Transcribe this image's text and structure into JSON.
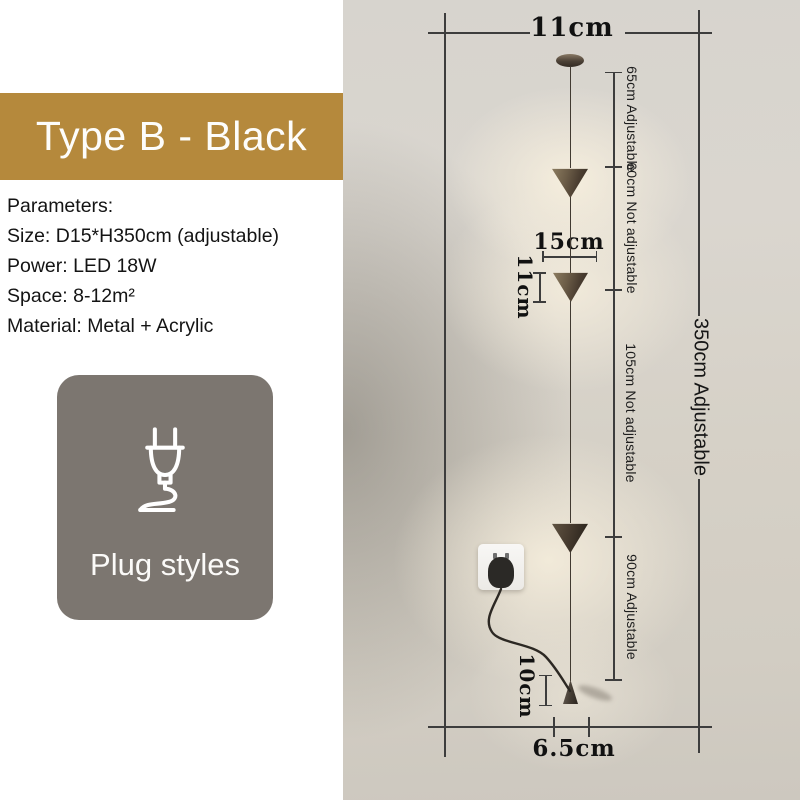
{
  "banner": {
    "label": "Type B - Black",
    "bg_color": "#b5893c",
    "text_color": "#ffffff"
  },
  "parameters": {
    "title": "Parameters:",
    "size": "Size: D15*H350cm (adjustable)",
    "power": "Power: LED 18W",
    "space": "Space: 8-12m²",
    "material": "Material: Metal + Acrylic"
  },
  "plug_box": {
    "label": "Plug styles",
    "icon": "plug-icon",
    "bg_color": "#7c7670"
  },
  "dimensions": {
    "canopy_width": "11cm",
    "segment_top": "65cm Adjustable",
    "segment_upper": "60cm Not adjustable",
    "segment_middle": "105cm Not adjustable",
    "segment_lower": "90cm Adjustable",
    "total_height": "350cm Adjustable",
    "shade_spacing": "15cm",
    "shade_height": "11cm",
    "floor_spike_height": "10cm",
    "base_width": "6.5cm"
  },
  "colors": {
    "dimension_line": "#3d3d3d",
    "photo_backdrop": "#d5d0c6",
    "lamp_bronze": "#6b5c47"
  }
}
